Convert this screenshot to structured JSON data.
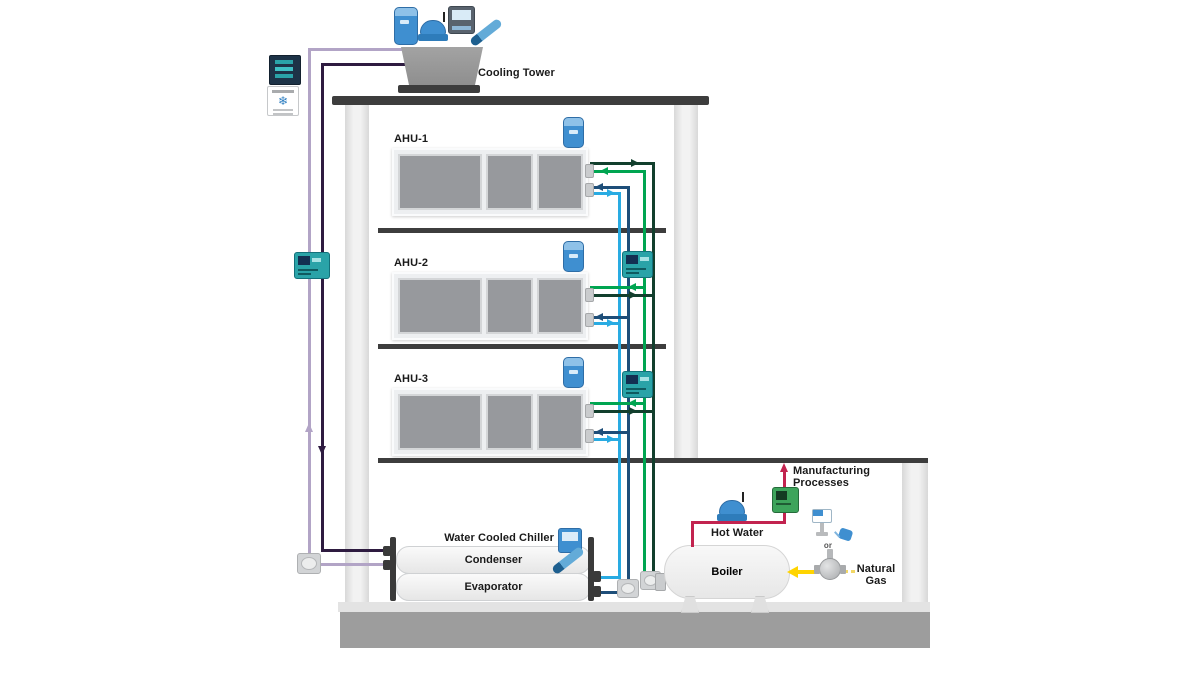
{
  "labels": {
    "cooling_tower": "Cooling Tower",
    "ahu_1": "AHU-1",
    "ahu_2": "AHU-2",
    "ahu_3": "AHU-3",
    "water_cooled_chiller": "Water Cooled Chiller",
    "condenser": "Condenser",
    "evaporator": "Evaporator",
    "boiler": "Boiler",
    "hot_water": "Hot Water",
    "manufacturing_line1": "Manufacturing",
    "manufacturing_line2": "Processes",
    "natural_gas_line1": "Natural",
    "natural_gas_line2": "Gas",
    "or_label": "or",
    "snowflake_glyph": "❄"
  },
  "colors": {
    "chilled_supply": "#29abe2",
    "chilled_return": "#1e4e79",
    "heating_supply": "#00a551",
    "heating_return": "#123f2d",
    "condenser_supply": "#2e1b40",
    "condenser_return": "#b2a4c6",
    "process_hot_water": "#c2234f",
    "natural_gas": "#ffd400",
    "controller_teal": "#2aa3a8",
    "device_blue": "#3f8fd0"
  }
}
